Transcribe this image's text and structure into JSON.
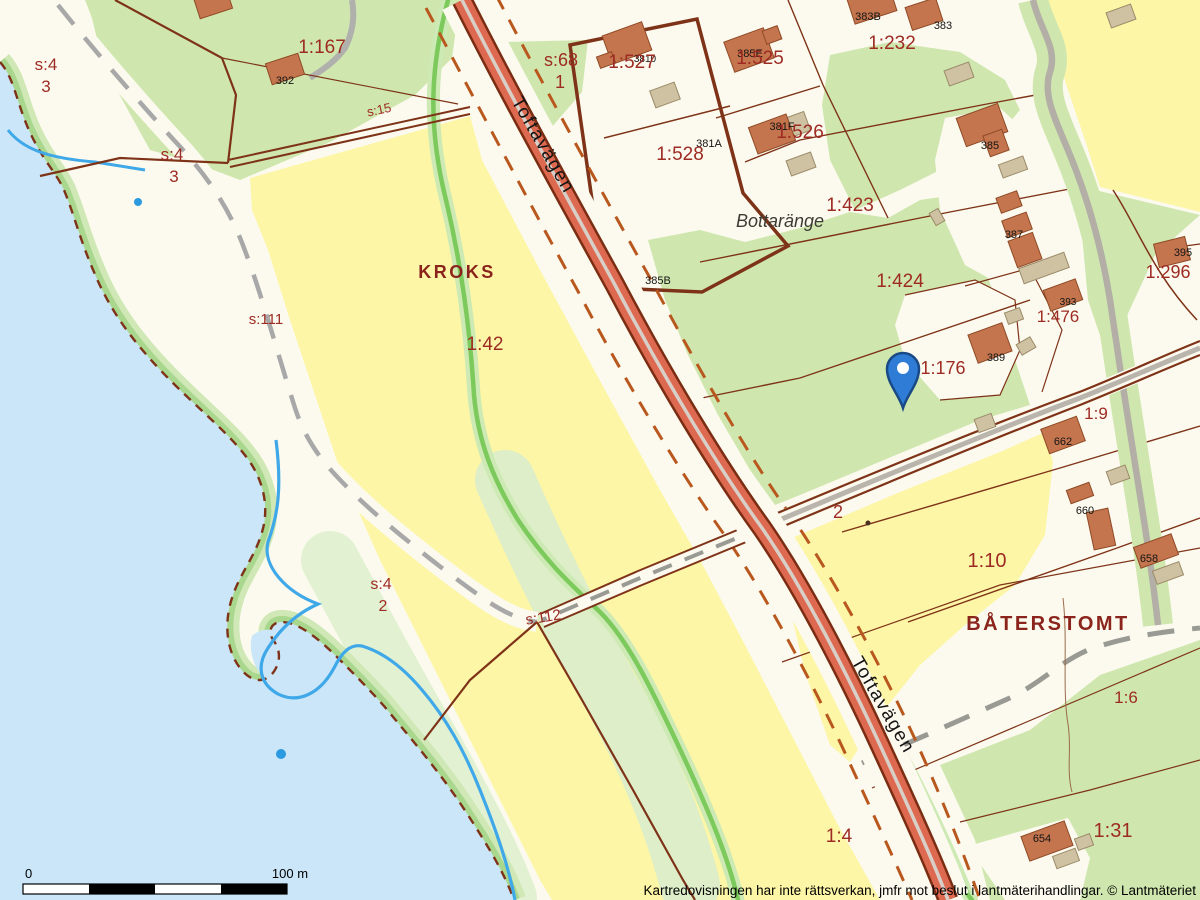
{
  "map": {
    "place_names": [
      "KROKS",
      "BÅTERSTOMT",
      "Bottaränge"
    ],
    "road_name": "Toftavägen",
    "colors": {
      "water": "#cbe6f8",
      "field_yellow": "#fdf6a6",
      "pasture_green": "#cfe7ae",
      "land_cream": "#fcfaee",
      "road_red": "#dd6a50",
      "road_gray": "#b9b4ac",
      "boundary_brown": "#7e3318",
      "parcel_label_red": "#9e2b23",
      "stream_green": "#7cc95c",
      "stream_blue": "#3fa8e8",
      "pin_blue": "#2e7cd6"
    }
  },
  "pin": {
    "x": 903,
    "y": 372
  },
  "scalebar": {
    "x": 23,
    "y": 884,
    "segment_width": 66,
    "height": 10,
    "label_start": "0",
    "label_end": "100 m"
  },
  "copyright": "Kartredovisningen har inte rättsverkan, jmfr mot beslut i lantmäterihandlingar. © Lantmäteriet",
  "labels": [
    {
      "t": "3810",
      "x": 645,
      "y": 62,
      "fs": 10,
      "c": "lb"
    },
    {
      "t": "381A",
      "x": 709,
      "y": 147,
      "fs": 11,
      "c": "lb"
    },
    {
      "t": "385B",
      "x": 658,
      "y": 284,
      "fs": 11,
      "c": "lb"
    },
    {
      "t": "385E",
      "x": 750,
      "y": 57,
      "fs": 11,
      "c": "lb"
    },
    {
      "t": "381F",
      "x": 782,
      "y": 130,
      "fs": 11,
      "c": "lb"
    },
    {
      "t": "383B",
      "x": 868,
      "y": 20,
      "fs": 11,
      "c": "lb"
    },
    {
      "t": "383",
      "x": 943,
      "y": 29,
      "fs": 11,
      "c": "lb"
    },
    {
      "t": "385",
      "x": 990,
      "y": 149,
      "fs": 11,
      "c": "lb"
    },
    {
      "t": "387",
      "x": 1014,
      "y": 238,
      "fs": 11,
      "c": "lb"
    },
    {
      "t": "393",
      "x": 1068,
      "y": 305,
      "fs": 10,
      "c": "lb"
    },
    {
      "t": "395",
      "x": 1183,
      "y": 256,
      "fs": 11,
      "c": "lb"
    },
    {
      "t": "389",
      "x": 996,
      "y": 361,
      "fs": 11,
      "c": "lb"
    },
    {
      "t": "662",
      "x": 1063,
      "y": 445,
      "fs": 11,
      "c": "lb"
    },
    {
      "t": "660",
      "x": 1085,
      "y": 514,
      "fs": 11,
      "c": "lb"
    },
    {
      "t": "658",
      "x": 1149,
      "y": 562,
      "fs": 11,
      "c": "lb"
    },
    {
      "t": "654",
      "x": 1042,
      "y": 842,
      "fs": 11,
      "c": "lb"
    },
    {
      "t": "392",
      "x": 285,
      "y": 84,
      "fs": 11,
      "c": "lb"
    },
    {
      "t": "s:4",
      "x": 46,
      "y": 70,
      "fs": 17,
      "c": "lr"
    },
    {
      "t": "3",
      "x": 46,
      "y": 92,
      "fs": 17,
      "c": "lr"
    },
    {
      "t": "s:4",
      "x": 172,
      "y": 160,
      "fs": 17,
      "c": "lr"
    },
    {
      "t": "3",
      "x": 174,
      "y": 182,
      "fs": 17,
      "c": "lr"
    },
    {
      "t": "1:167",
      "x": 322,
      "y": 53,
      "fs": 19,
      "c": "lr"
    },
    {
      "t": "s:15",
      "x": 380,
      "y": 114,
      "fs": 13,
      "c": "lr",
      "r": -12
    },
    {
      "t": "s:68",
      "x": 561,
      "y": 66,
      "fs": 18,
      "c": "lr"
    },
    {
      "t": "1",
      "x": 560,
      "y": 88,
      "fs": 18,
      "c": "lr"
    },
    {
      "t": "1:527",
      "x": 632,
      "y": 68,
      "fs": 19,
      "c": "lr"
    },
    {
      "t": "1:528",
      "x": 680,
      "y": 160,
      "fs": 19,
      "c": "lr"
    },
    {
      "t": "1:525",
      "x": 760,
      "y": 64,
      "fs": 19,
      "c": "lr"
    },
    {
      "t": "1:526",
      "x": 800,
      "y": 138,
      "fs": 19,
      "c": "lr"
    },
    {
      "t": "1:232",
      "x": 892,
      "y": 49,
      "fs": 19,
      "c": "lr"
    },
    {
      "t": "1:423",
      "x": 850,
      "y": 211,
      "fs": 19,
      "c": "lr"
    },
    {
      "t": "1:424",
      "x": 900,
      "y": 287,
      "fs": 19,
      "c": "lr"
    },
    {
      "t": "1:296",
      "x": 1168,
      "y": 278,
      "fs": 18,
      "c": "lr"
    },
    {
      "t": "1:476",
      "x": 1058,
      "y": 322,
      "fs": 17,
      "c": "lr"
    },
    {
      "t": "1:176",
      "x": 943,
      "y": 374,
      "fs": 18,
      "c": "lr"
    },
    {
      "t": "1:9",
      "x": 1096,
      "y": 419,
      "fs": 17,
      "c": "lr"
    },
    {
      "t": "1:10",
      "x": 987,
      "y": 567,
      "fs": 20,
      "c": "lr"
    },
    {
      "t": "1:42",
      "x": 485,
      "y": 350,
      "fs": 19,
      "c": "lr"
    },
    {
      "t": "s:111",
      "x": 266,
      "y": 324,
      "fs": 15,
      "c": "lr"
    },
    {
      "t": "2",
      "x": 838,
      "y": 518,
      "fs": 18,
      "c": "lr"
    },
    {
      "t": "s:4",
      "x": 381,
      "y": 589,
      "fs": 16,
      "c": "lr"
    },
    {
      "t": "2",
      "x": 383,
      "y": 611,
      "fs": 16,
      "c": "lr"
    },
    {
      "t": "s:112",
      "x": 544,
      "y": 622,
      "fs": 15,
      "c": "lr",
      "r": -9
    },
    {
      "t": "1:6",
      "x": 1126,
      "y": 703,
      "fs": 17,
      "c": "lr"
    },
    {
      "t": "1:31",
      "x": 1113,
      "y": 837,
      "fs": 20,
      "c": "lr"
    },
    {
      "t": "1:4",
      "x": 839,
      "y": 842,
      "fs": 19,
      "c": "lr"
    },
    {
      "t": "KROKS",
      "x": 457,
      "y": 278,
      "fs": 18,
      "c": "ln"
    },
    {
      "t": "BÅTERSTOMT",
      "x": 1048,
      "y": 630,
      "fs": 20,
      "c": "ln"
    },
    {
      "t": "Bottaränge",
      "x": 780,
      "y": 227,
      "fs": 18,
      "c": "li"
    },
    {
      "t": "Toftavägen",
      "x": 538,
      "y": 148,
      "fs": 19,
      "c": "lo",
      "r": 60
    },
    {
      "t": "Toftavägen",
      "x": 878,
      "y": 708,
      "fs": 19,
      "c": "lo",
      "r": 60
    }
  ],
  "buildings": [
    [
      196,
      -8,
      34,
      22,
      -18,
      "h"
    ],
    [
      268,
      58,
      34,
      22,
      -18,
      "h"
    ],
    [
      606,
      28,
      42,
      30,
      -20,
      "h"
    ],
    [
      598,
      54,
      16,
      12,
      -20,
      "h"
    ],
    [
      652,
      86,
      26,
      18,
      -20,
      "s"
    ],
    [
      728,
      34,
      42,
      32,
      -20,
      "h"
    ],
    [
      764,
      28,
      16,
      14,
      -20,
      "h"
    ],
    [
      778,
      116,
      30,
      20,
      -20,
      "s"
    ],
    [
      752,
      120,
      40,
      28,
      -20,
      "h"
    ],
    [
      788,
      156,
      26,
      16,
      -20,
      "s"
    ],
    [
      850,
      -8,
      44,
      26,
      -18,
      "h"
    ],
    [
      908,
      2,
      32,
      24,
      -18,
      "h"
    ],
    [
      946,
      66,
      26,
      16,
      -20,
      "s"
    ],
    [
      960,
      110,
      44,
      30,
      -20,
      "h"
    ],
    [
      986,
      132,
      20,
      22,
      -20,
      "h"
    ],
    [
      1108,
      8,
      26,
      16,
      -20,
      "s"
    ],
    [
      1000,
      160,
      26,
      14,
      -20,
      "s"
    ],
    [
      998,
      194,
      22,
      16,
      -20,
      "h"
    ],
    [
      1004,
      216,
      26,
      18,
      -20,
      "h"
    ],
    [
      1012,
      236,
      26,
      28,
      -20,
      "h"
    ],
    [
      1020,
      260,
      48,
      16,
      -20,
      "s"
    ],
    [
      1046,
      284,
      34,
      22,
      -20,
      "h"
    ],
    [
      1006,
      310,
      16,
      12,
      -20,
      "s"
    ],
    [
      1018,
      340,
      16,
      12,
      -30,
      "s"
    ],
    [
      972,
      328,
      36,
      30,
      -20,
      "h"
    ],
    [
      932,
      210,
      10,
      14,
      -30,
      "s"
    ],
    [
      1156,
      240,
      32,
      24,
      -14,
      "h"
    ],
    [
      1044,
      422,
      38,
      26,
      -20,
      "h"
    ],
    [
      976,
      416,
      18,
      14,
      -20,
      "s"
    ],
    [
      1108,
      468,
      20,
      14,
      -20,
      "s"
    ],
    [
      1068,
      486,
      24,
      14,
      -20,
      "h"
    ],
    [
      1090,
      510,
      22,
      38,
      -12,
      "h"
    ],
    [
      1136,
      540,
      40,
      22,
      -20,
      "h"
    ],
    [
      1154,
      566,
      28,
      14,
      -20,
      "s"
    ],
    [
      1024,
      828,
      46,
      26,
      -20,
      "h"
    ],
    [
      1054,
      852,
      24,
      13,
      -20,
      "s"
    ],
    [
      1076,
      836,
      16,
      12,
      -20,
      "s"
    ]
  ]
}
